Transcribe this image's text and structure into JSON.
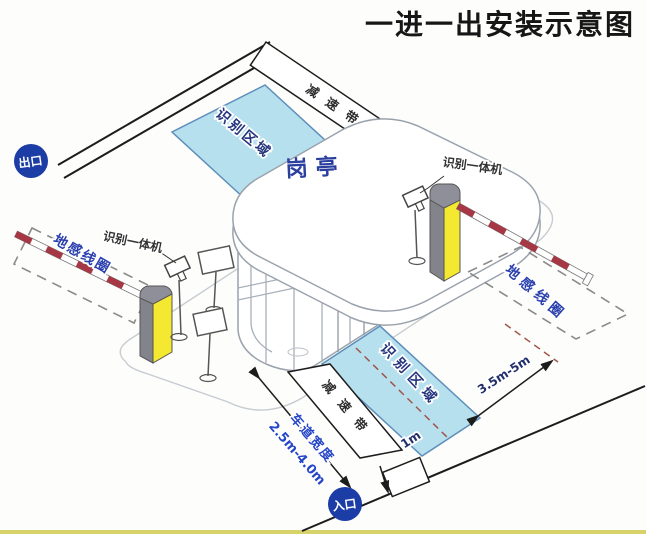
{
  "title": "一进一出安装示意图",
  "booth": {
    "label": "岗亭"
  },
  "exit_lane": {
    "badge": "出口",
    "speed_bump": "减速带",
    "recognition_area": "识别区域",
    "ground_coil": "地感线圈",
    "camera_label": "识别一体机"
  },
  "entrance_lane": {
    "badge": "入口",
    "speed_bump": "减速带",
    "recognition_area": "识别区域",
    "ground_coil": "地感线圈",
    "camera_label": "识别一体机",
    "dim_coil_distance": "3.5m-5m",
    "dim_area_offset": "1m",
    "lane_width_label": "车道宽度",
    "lane_width_range": "2.5m-4.0m"
  },
  "colors": {
    "recognition_area_fill": "#b7e0ef",
    "recognition_area_border": "#5e8fba",
    "badge_background": "#1c3ca6",
    "coil_label_blue": "#2a3fae",
    "dimension_blue": "#2646c8",
    "barrier_red": "#a63744",
    "machine_yellow": "#f4e830",
    "machine_gray": "#8f8f99",
    "line_black": "#1c1c1c"
  }
}
